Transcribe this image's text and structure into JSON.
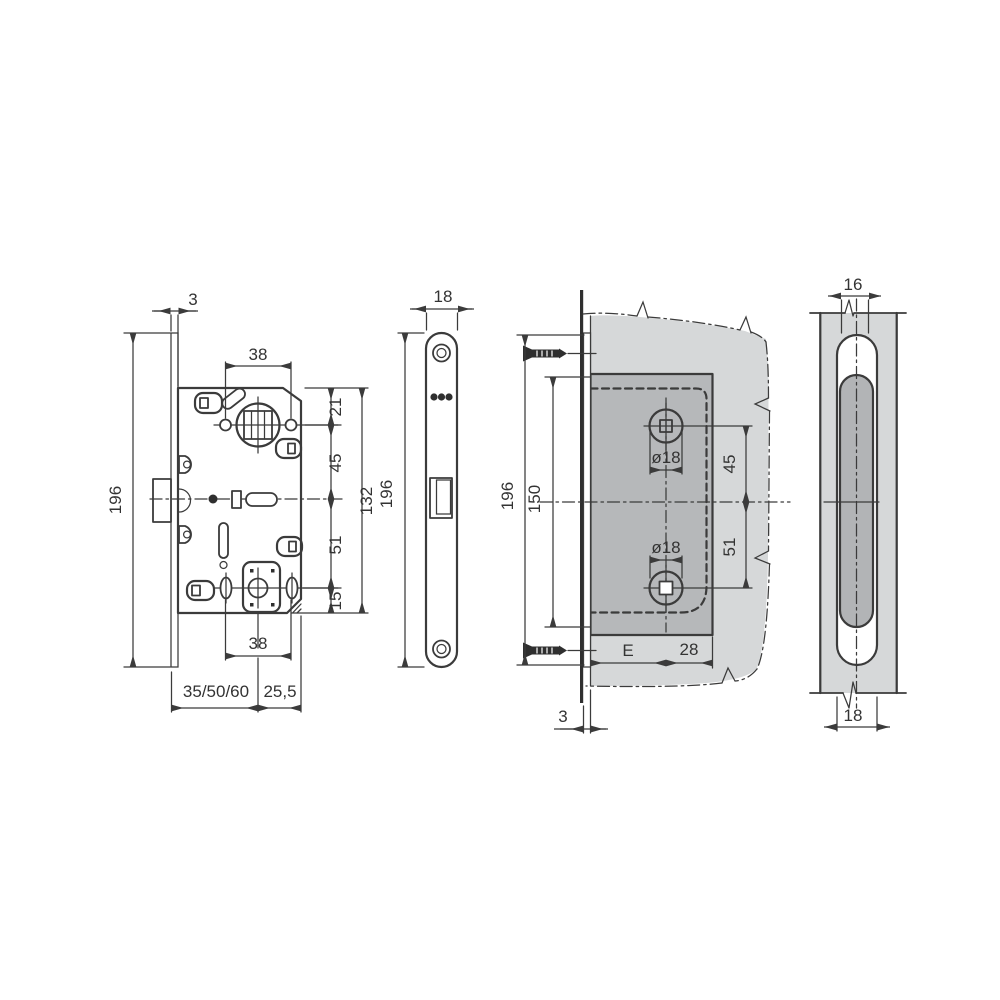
{
  "drawing": {
    "type": "technical-drawing",
    "subject": "magnetic mortise lock installation dimensions",
    "colors": {
      "line": "#3b3b3b",
      "door_fill": "#d6d8d9",
      "recess_fill": "#b6b8ba",
      "background": "#ffffff"
    }
  },
  "dims": {
    "v1": {
      "faceplate_thickness": "3",
      "hole_spacing_top": "38",
      "top_to_spindle": "21",
      "spindle_to_center": "45",
      "body_height": "132",
      "center_to_wc": "51",
      "wc_to_bottom": "15",
      "total_height": "196",
      "hole_spacing_bottom": "38",
      "backset": "35/50/60",
      "center_to_rear": "25,5"
    },
    "v2": {
      "plate_width": "18",
      "plate_height": "196"
    },
    "v3": {
      "plate_height": "196",
      "recess_height": "150",
      "spindle_hole_dia": "ø18",
      "spindle_to_center": "45",
      "wc_hole_dia": "ø18",
      "center_to_wc": "51",
      "backset": "E",
      "center_to_rear": "28",
      "faceplate_thickness": "3"
    },
    "v4": {
      "mortise_width": "16",
      "recess_width": "18"
    }
  }
}
